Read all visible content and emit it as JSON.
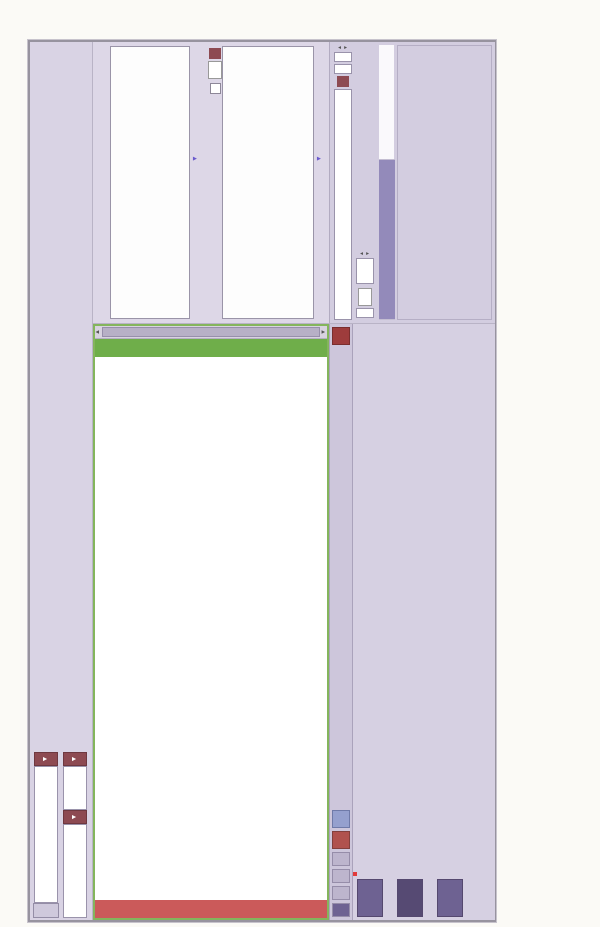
{
  "caption": {
    "figure_title": "图6-75　11月21日，最后交易日",
    "para1": "IO1411 合约到期，不被行权的 Call 收取全部权利金，收益达到 10.11%。",
    "para2": "注：以 100 万元资金为例，3 个行权价卖出的 Put，收取的权利金总和为 101100（16000+68600+16500），得到",
    "para3": "期收益率为 10.11%。"
  },
  "topbar": {
    "back_button": "<",
    "exchange_select": "中金所(权)",
    "product_select": "沪深300期权",
    "month_select": "201411",
    "quote_headers": [
      "主力/标的",
      "最新价",
      "涨跌",
      "涨跌幅",
      "买价",
      "卖价",
      "最高价",
      "最低价",
      "成交量",
      "到期日(天数)",
      "更新时间",
      "线图"
    ],
    "quote_rows": [
      [
        "IF 1411",
        "2565.4",
        "▲28.8",
        "1.14%",
        "2565.4",
        "2565.8",
        "2566.6",
        "2530.6",
        "70275",
        "2014/11/21(1)",
        "16:04:37",
        "icons"
      ],
      [
        "沪深300",
        "2583.46",
        "▲46.36",
        "1.83%",
        "-",
        "-",
        "2585.36",
        "2530.03",
        "14375081",
        "-",
        "15:01:03",
        "icons"
      ]
    ],
    "icons": [
      "line-chart-icon",
      "bar-chart-icon"
    ]
  },
  "chain": {
    "call_banner": "看涨期权 (Call)",
    "put_banner": "看跌期权 (Put)",
    "headers": [
      "买价",
      "卖价",
      "最新价",
      "现量",
      "成交量",
      "卖",
      "买",
      "",
      "行权价",
      "",
      "买",
      "卖",
      "成交量",
      "现量",
      "最新价",
      "卖价",
      "买价"
    ],
    "strikes": [
      "2200",
      "2250",
      "2300",
      "2350",
      "2400",
      "2450",
      "2500",
      "2550",
      "2600",
      "2650",
      "2700",
      "2750"
    ],
    "strike_special": {
      "2550": "red",
      "2600": "green"
    },
    "call": {
      "bid": [
        "363.5",
        "313.4",
        "263",
        "214.7",
        "165",
        "113.4",
        "60.6",
        "17.5",
        "0.8",
        "0.1",
        "0.2",
        "0.1"
      ],
      "ask": [
        "366.5",
        "316.4",
        "264.9",
        "216.4",
        "166.8",
        "115.8",
        "60.7",
        "19.3",
        "1.6",
        "0.1",
        "0.9",
        "0.4"
      ],
      "last": [
        "362.7",
        "313.2",
        "264.6",
        "214.8",
        "165",
        "113.4",
        "60.7",
        "17.8",
        "0.8",
        "0.1",
        "0.4",
        "0.1"
      ],
      "qty": [
        "1",
        "1",
        "1",
        "1",
        "7",
        "1",
        "1",
        "1",
        "100",
        "11",
        "1",
        "1"
      ],
      "vol": [
        "281",
        "293",
        "912",
        "809",
        "1554",
        "926",
        "3428",
        "3576",
        "3581",
        "1785",
        "695",
        "521"
      ],
      "green_rows_bid": [
        9,
        11
      ],
      "green_rows_ask": [
        9
      ],
      "green_rows_last": [
        9,
        11
      ]
    },
    "put": {
      "vol": [
        "71",
        "662",
        "2809",
        "1373",
        "929",
        "1166",
        "2255",
        "4823",
        "1278",
        "644",
        "69",
        "84"
      ],
      "qty": [
        "1",
        "2",
        "1",
        "1",
        "4",
        "1",
        "1",
        "1",
        "1",
        "12",
        "5",
        "1"
      ],
      "last": [
        "1.3",
        "0.5",
        "1",
        "0.6",
        "0.4",
        "0.8",
        "0.8",
        "0.9",
        "35.3",
        "84.6",
        "114.7",
        "149.6"
      ],
      "ask": [
        "1.3",
        "0.5",
        "0.8",
        "0.8",
        "0.5",
        "0.6",
        "0.9",
        "0.9",
        "35.5",
        "86",
        "136.3",
        "276.1"
      ],
      "bid": [
        "0.2",
        "0.4",
        "0.5",
        "0.5",
        "0.4",
        "0.5",
        "0.8",
        "0.8",
        "35.2",
        "83.6",
        "132.3",
        "149.9"
      ],
      "red_rows": [
        0,
        8,
        9,
        10,
        11
      ]
    }
  },
  "charts": {
    "prob_title": "概率",
    "pl_title": "盈亏",
    "refresh": {
      "checkbox": "",
      "prefix": "每",
      "value": "15",
      "apply": "▶",
      "suffix": "秒更新"
    },
    "x_left": "2500",
    "x_marker": "2583.46",
    "x_right": "2600",
    "pl_zero": "0"
  },
  "analysis": {
    "mode_select": "到期盈亏分析",
    "go_button": "▶",
    "vol_label": "波动率",
    "vol_value": "28.5",
    "expiry_label": "到期日",
    "expiry_value": "2014/11/21",
    "expiry_spin": "15",
    "elapsed_label": "经过",
    "elapsed_value": "0",
    "stats": [
      {
        "label": "最大收益",
        "value": "—"
      },
      {
        "label": "最大亏损",
        "value": "—"
      },
      {
        "label": "收到权利金",
        "value": "0.00"
      }
    ],
    "futures_label": "约当期货手数",
    "futures_value": "0.0000",
    "greek_headers": [
      "现值",
      "变化",
      "盈亏变化"
    ],
    "greeks": [
      {
        "name": "Delta",
        "pv": "0.0000",
        "chg": "0.2",
        "unit": "点",
        "pl": "0.00"
      },
      {
        "name": "Gamma",
        "pv": "0.0000",
        "chg": "0.2",
        "unit": "点",
        "pl": "0.00"
      },
      {
        "name": "Theta",
        "pv": "0.0000",
        "chg": "1",
        "unit": "天",
        "pl": "0.00"
      }
    ]
  },
  "toolbar": {
    "tabs": [
      "分析",
      "行权价",
      "合约别",
      "手数"
    ],
    "reset_button": "重置",
    "add_underlying_button": "加入标的期货",
    "one_click_button": "一键下单"
  },
  "bottom": {
    "rail_tabs": [
      "报单",
      "持仓",
      "资金"
    ],
    "headers": [
      "平",
      "□分析",
      "合约",
      "净仓",
      "多仓",
      "空仓",
      "手数",
      "价格条件",
      "最新价",
      "涨跌",
      "市值",
      "成本",
      "均价",
      "逐笔浮动盈亏",
      "逐笔浮动盈亏%"
    ],
    "rows": [
      {
        "close": "平",
        "contract": "IO 1411 2350P",
        "net": "-10",
        "long": "0",
        "short": "10",
        "last": "0.6",
        "chg": "▼1.8",
        "mv": "-600.00",
        "cost": "-16,000.00",
        "avg": "16",
        "fl": "15,400.00",
        "flp": "96.25%",
        "hl": false
      },
      {
        "close": "平",
        "contract": "IO 1411 2600C",
        "net": "-35",
        "long": "0",
        "short": "35",
        "last": "0.8",
        "chg": "▼5.1",
        "mv": "-2,800.00",
        "cost": "-68,600.00",
        "avg": "19.6",
        "fl": "65,800.00",
        "flp": "95.92%",
        "hl": false
      },
      {
        "close": "平",
        "contract": "IO 1411 2650C",
        "net": "-10",
        "long": "0",
        "short": "10",
        "last": "0.1",
        "chg": "▼2.5",
        "mv": "-100.00",
        "cost": "-16,500.00",
        "avg": "16.5",
        "fl": "16,400.00",
        "flp": "99.39%",
        "hl": true
      }
    ]
  }
}
